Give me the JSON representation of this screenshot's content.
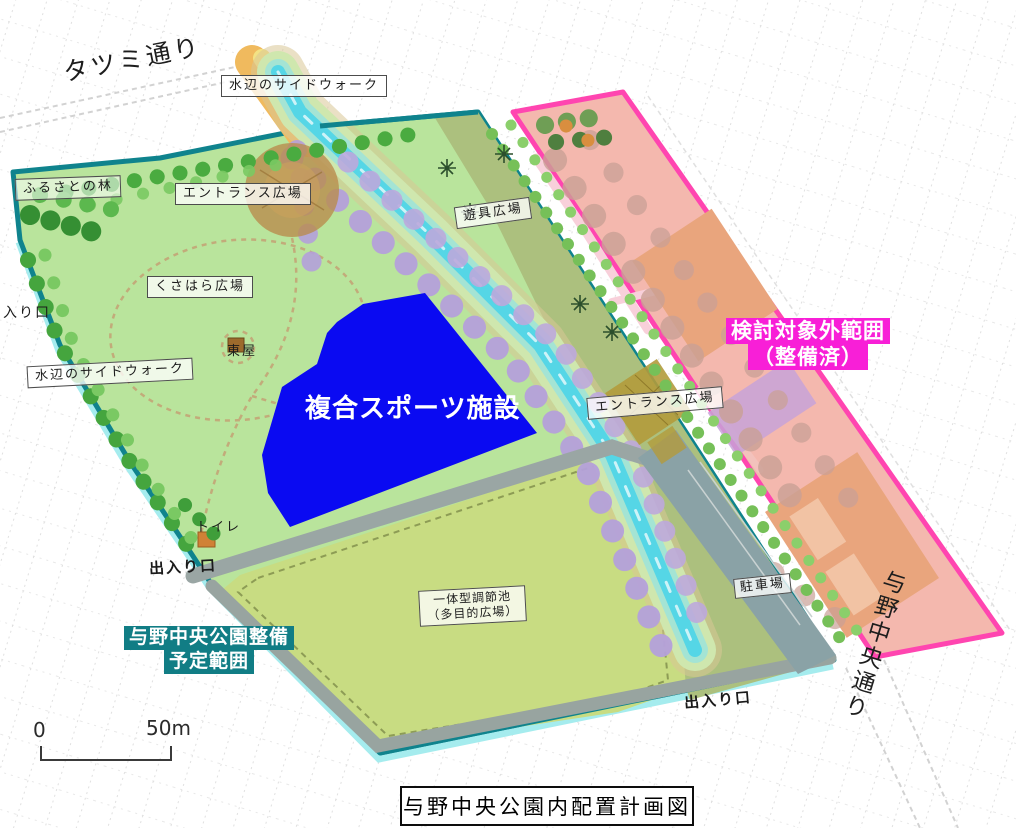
{
  "map": {
    "title": "与野中央公園内配置計画図",
    "streets": {
      "tatsumi": "タツミ通り",
      "yono_chuo": "与野中央通り"
    },
    "zones": {
      "sports_facility": "複合スポーツ施設",
      "planned_line1": "与野中央公園整備",
      "planned_line2": "予定範囲",
      "excluded_line1": "検討対象外範囲",
      "excluded_line2": "（整備済）"
    },
    "boxed_labels": {
      "waterside_top": "水辺のサイドウォーク",
      "furusato_forest": "ふるさとの林",
      "entrance_plaza_top": "エントランス広場",
      "playground_plaza": "遊具広場",
      "kusahara_plaza": "くさはら広場",
      "waterside_left": "水辺のサイドウォーク",
      "entrance_plaza_right": "エントランス広場",
      "pond_line1": "一体型調節池",
      "pond_line2": "（多目的広場）",
      "parking": "駐車場"
    },
    "plain_labels": {
      "azumaya": "東屋",
      "toilet": "トイレ",
      "exit_west": "出入り口",
      "exit_southwest": "出入り口",
      "exit_south": "出入り口"
    },
    "scale_bar": {
      "start": "0",
      "end": "50m"
    },
    "legend_colors": {
      "park_boundary": "#0f838d",
      "excluded_boundary": "#ff45b0",
      "sports_facility_fill": "#0a0af2",
      "excluded_label_bg": "#f81fd7",
      "planned_label_bg": "#117d85"
    }
  }
}
